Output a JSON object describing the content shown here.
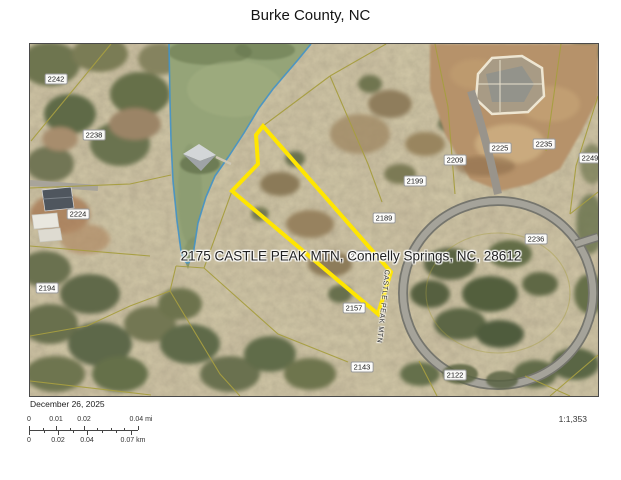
{
  "title": "Burke County, NC",
  "map": {
    "address_label": "2175 CASTLE PEAK MTN, Connelly Springs, NC, 28612",
    "road_label": "CASTLE PEAK MTN",
    "subject_parcel_id": "2175",
    "parcels": [
      "2242",
      "2238",
      "2224",
      "2194",
      "2209",
      "2199",
      "2189",
      "2225",
      "2235",
      "2249",
      "2236",
      "2157",
      "2143",
      "2122"
    ],
    "colors": {
      "parcel_highlight": "#ffe600",
      "shoreline": "#4292c8",
      "parcel_line": "#a79e40",
      "water": "#95a478"
    }
  },
  "footer": {
    "date": "December 26, 2025",
    "scale_ratio": "1:1,353",
    "scale_mi": [
      "0",
      "0.01",
      "0.02",
      "0.04 mi"
    ],
    "scale_km": [
      "0",
      "0.02",
      "0.04",
      "0.07 km"
    ]
  }
}
